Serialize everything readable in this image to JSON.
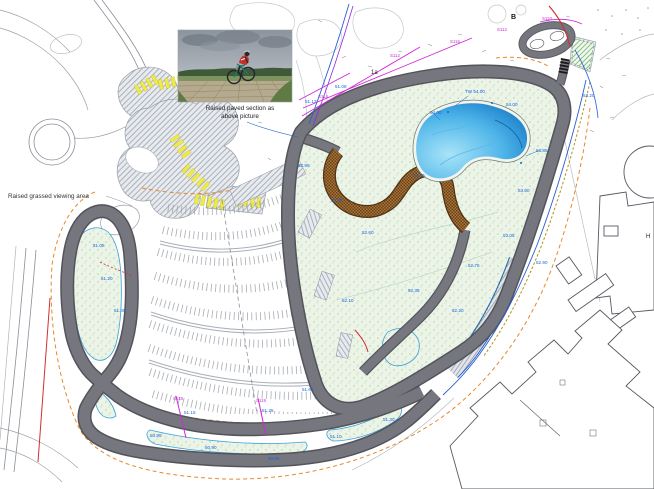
{
  "meta": {
    "type": "site-plan",
    "subject": "cycle-circuit-and-parking-site-plan"
  },
  "colors": {
    "track_surface": "#76767e",
    "track_edge": "#53535b",
    "water": "#1273c4",
    "grass_stipple": "#ecf4e8",
    "dirt_track": "#a8743c",
    "parking_bays_yellow": "#efe94e",
    "boundary_orange": "#e8882a",
    "survey_magenta": "#d028d8",
    "levels_blue": "#1565d8",
    "footpath_blue": "#2a5fd0",
    "red_line": "#d03030"
  },
  "annotations": [
    {
      "x": 240,
      "y": 110,
      "t": "Raised paved section as",
      "c": "caption"
    },
    {
      "x": 240,
      "y": 118,
      "t": "above picture",
      "c": "caption"
    },
    {
      "x": 8,
      "y": 198,
      "t": "Raised grassed viewing area",
      "c": "note"
    },
    {
      "x": 511,
      "y": 19,
      "t": "B",
      "c": "bold"
    },
    {
      "x": 371,
      "y": 74,
      "t": "1a",
      "c": "small"
    },
    {
      "x": 646,
      "y": 238,
      "t": "H",
      "c": "small"
    },
    {
      "x": 93,
      "y": 247,
      "t": "51.05",
      "c": "blue"
    },
    {
      "x": 101,
      "y": 280,
      "t": "51.20",
      "c": "blue"
    },
    {
      "x": 114,
      "y": 312,
      "t": "51.45",
      "c": "blue"
    },
    {
      "x": 150,
      "y": 437,
      "t": "50.85",
      "c": "blue"
    },
    {
      "x": 205,
      "y": 449,
      "t": "50.90",
      "c": "blue"
    },
    {
      "x": 268,
      "y": 460,
      "t": "50.95",
      "c": "blue"
    },
    {
      "x": 330,
      "y": 438,
      "t": "51.10",
      "c": "blue"
    },
    {
      "x": 383,
      "y": 421,
      "t": "51.30",
      "c": "blue"
    },
    {
      "x": 302,
      "y": 391,
      "t": "51.60",
      "c": "blue"
    },
    {
      "x": 342,
      "y": 302,
      "t": "52.10",
      "c": "blue"
    },
    {
      "x": 331,
      "y": 202,
      "t": "52.85",
      "c": "blue"
    },
    {
      "x": 362,
      "y": 234,
      "t": "52.60",
      "c": "blue"
    },
    {
      "x": 408,
      "y": 292,
      "t": "52.35",
      "c": "blue"
    },
    {
      "x": 452,
      "y": 312,
      "t": "52.20",
      "c": "blue"
    },
    {
      "x": 468,
      "y": 267,
      "t": "52.75",
      "c": "blue"
    },
    {
      "x": 503,
      "y": 237,
      "t": "53.05",
      "c": "blue"
    },
    {
      "x": 518,
      "y": 192,
      "t": "53.60",
      "c": "blue"
    },
    {
      "x": 430,
      "y": 114,
      "t": "54.00",
      "c": "blue"
    },
    {
      "x": 465,
      "y": 93,
      "t": "TW 54.00",
      "c": "blue"
    },
    {
      "x": 506,
      "y": 106,
      "t": "54.00",
      "c": "blue"
    },
    {
      "x": 536,
      "y": 152,
      "t": "53.85",
      "c": "blue"
    },
    {
      "x": 413,
      "y": 177,
      "t": "53.40",
      "c": "blue"
    },
    {
      "x": 298,
      "y": 167,
      "t": "52.95",
      "c": "blue"
    },
    {
      "x": 536,
      "y": 264,
      "t": "52.90",
      "c": "blue"
    },
    {
      "x": 583,
      "y": 97,
      "t": "53.20",
      "c": "blue"
    },
    {
      "x": 184,
      "y": 414,
      "t": "51.15",
      "c": "blue"
    },
    {
      "x": 262,
      "y": 412,
      "t": "51.25",
      "c": "blue"
    },
    {
      "x": 305,
      "y": 103,
      "t": "51.12",
      "c": "blue"
    },
    {
      "x": 335,
      "y": 88,
      "t": "51.08",
      "c": "blue"
    },
    {
      "x": 390,
      "y": 57,
      "t": "S112",
      "c": "magenta"
    },
    {
      "x": 450,
      "y": 43,
      "t": "S116",
      "c": "magenta"
    },
    {
      "x": 497,
      "y": 31,
      "t": "S112",
      "c": "magenta"
    },
    {
      "x": 318,
      "y": 98,
      "t": "S114",
      "c": "magenta"
    },
    {
      "x": 173,
      "y": 400,
      "t": "S118",
      "c": "magenta"
    },
    {
      "x": 256,
      "y": 402,
      "t": "S119",
      "c": "magenta"
    },
    {
      "x": 542,
      "y": 20,
      "t": "S110",
      "c": "magenta"
    }
  ]
}
